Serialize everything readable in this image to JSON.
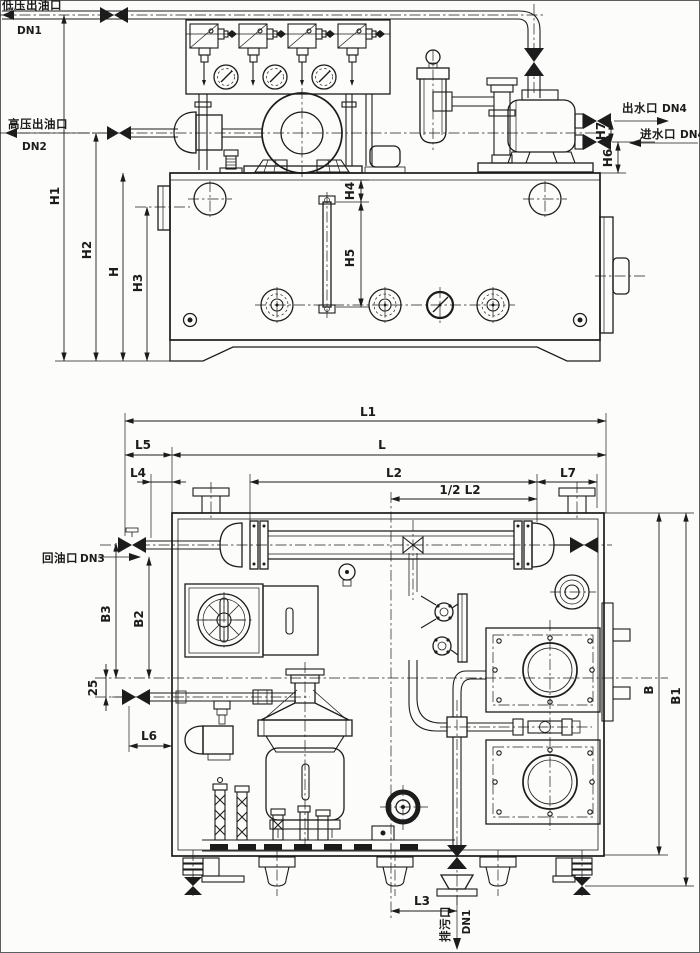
{
  "colors": {
    "ink": "#1c1c1c",
    "background": "#fcfcfa"
  },
  "ports": {
    "low_pressure_oil_outlet": {
      "name": "低压出油口",
      "size": "DN1"
    },
    "high_pressure_oil_outlet": {
      "name": "高压出油口",
      "size": "DN2"
    },
    "water_outlet": {
      "name": "出水口",
      "size": "DN4"
    },
    "water_inlet": {
      "name": "进水口",
      "size": "DN4"
    },
    "oil_return": {
      "name": "回油口",
      "size": "DN3"
    },
    "drain": {
      "name": "排污口",
      "size": "DN1"
    }
  },
  "dimensions": {
    "front_view": {
      "h1": "H1",
      "h2": "H2",
      "h": "H",
      "h3": "H3",
      "h4": "H4",
      "h5": "H5",
      "h6": "H6",
      "h7": "H7"
    },
    "plan_view": {
      "l1": "L1",
      "l": "L",
      "l2": "L2",
      "half_l2": "1/2 L2",
      "l3": "L3",
      "l4": "L4",
      "l5": "L5",
      "l6": "L6",
      "l7": "L7",
      "b": "B",
      "b1": "B1",
      "b2": "B2",
      "b3": "B3",
      "offset_25": "25"
    }
  }
}
